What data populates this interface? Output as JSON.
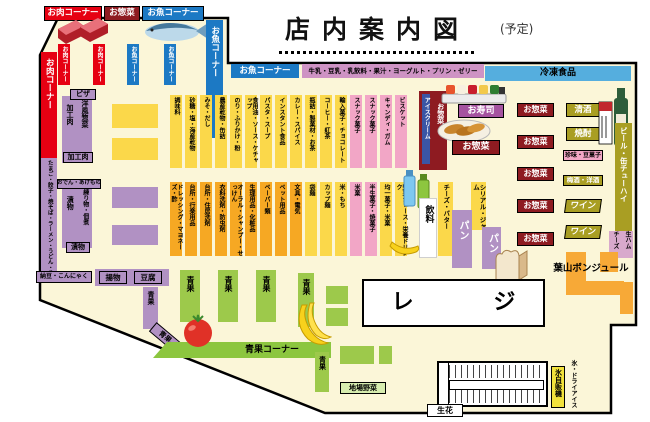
{
  "title": {
    "text": "店内案内図",
    "note": "(予定)"
  },
  "headers": {
    "meat": "お肉コーナー",
    "deli": "お惣菜",
    "fish": "お魚コーナー"
  },
  "bands": {
    "fish": "お魚コーナー",
    "dairy": "牛乳・豆乳・乳飲料・果汁・ヨーグルト・プリン・ゼリー",
    "frozen": "冷凍食品"
  },
  "left_bars": {
    "meat": "お肉コーナー",
    "noodles": "たまご・餃子・焼そば・ラーメン・うどん・そば",
    "fish": "お魚コーナー"
  },
  "fresh_cols": {
    "meat1": "お肉コーナー",
    "meat2": "お肉コーナー",
    "fish1": "お魚コーナー",
    "fish2": "お魚コーナー"
  },
  "aisle_pizza": {
    "top": "ピザ",
    "left": "加工肉",
    "right": "洋風惣菜",
    "bottom": "加工肉"
  },
  "aisle_oden": {
    "top": "おでん・あげもの",
    "left": "漬物",
    "right": "練り物・佃煮",
    "bottom": "漬物"
  },
  "deli_left": {
    "natto": "納豆・こんにゃく",
    "fried": "揚物",
    "tofu": "豆腐"
  },
  "grocery_top": [
    "調味料",
    "砂糖・塩・海産乾物",
    "みそ・だし",
    "農産乾物・缶詰",
    "のり・ふりかけ・粉",
    "食用油・ソース・ケチャップ",
    "パスタ・スープ",
    "インスタント食品",
    "カレー・スパイス",
    "瓶詰・製菓材・お茶",
    "コーヒー・紅茶",
    "輸入菓子・チョコレート",
    "スナック菓子",
    "スナック菓子",
    "キャンディ・ガム",
    "ビスケット"
  ],
  "grocery_bottom": [
    "ドレッシング・マヨネーズ・酢",
    "台所・行楽用品",
    "台所・住居洗剤",
    "衣料洗剤・防虫剤",
    "オーラル・シャンプー・せっけん",
    "生理用品・化粧品",
    "ペーパー類",
    "ペット用品",
    "文具・電気",
    "袋麺",
    "カップ麺",
    "米・もち",
    "米菓",
    "半生菓子・焼菓子",
    "均一菓子・米菓",
    "野菜ジュース・栄養ドリンク"
  ],
  "prepared": {
    "sushi": "お寿司",
    "deli_label": "お惣菜",
    "ice_cream": "アイスクリーム",
    "deli_side": "お惣菜",
    "deli_list": [
      "お惣菜",
      "お惣菜",
      "お惣菜",
      "お惣菜",
      "お惣菜"
    ]
  },
  "liquor": {
    "sake": "清酒",
    "shochu": "焼酎",
    "snacks": "珍味・豆菓子",
    "plum": "梅酒・洋酒",
    "wine1": "ワイン",
    "wine2": "ワイン",
    "beer": "ビール・缶チューハイ",
    "ham": "生ハム",
    "cheese": "チーズ"
  },
  "bakery": {
    "name": "葉山ボンジュール",
    "bread1": "パン",
    "bread2": "パン",
    "cereal": "シリアル・ジャム",
    "cheese_butter": "チーズ・バター",
    "drinks": "飲料"
  },
  "produce": {
    "corner": "青果コーナー",
    "col1": "青果",
    "col2": "青果",
    "col3": "青果",
    "col4": "青果",
    "strip": "青果",
    "strip2": "青果",
    "diag": "青果",
    "local": "地場野菜"
  },
  "front": {
    "register": "レ ジ",
    "flowers": "生花",
    "ice_vending": "氷自販機",
    "ice_dry": "氷・ドライアイス"
  },
  "colors": {
    "red": "#e60012",
    "darkred": "#8e1b21",
    "blue": "#1c79c4",
    "frozenblue": "#55aede",
    "dairyband": "#ce93c4",
    "yellow": "#fbd84a",
    "orange": "#f6a823",
    "pink": "#f2a6c6",
    "purple": "#b191c3",
    "green": "#9dc94b",
    "greenbar": "#8cc63f",
    "olive": "#a99e23",
    "navy": "#3a55a5",
    "bakeryorange": "#f7a937",
    "cream": "#fbf6d8",
    "magenta": "#a553a0",
    "palegreen": "#d7edaf",
    "iceyellow": "#f2e23b"
  }
}
